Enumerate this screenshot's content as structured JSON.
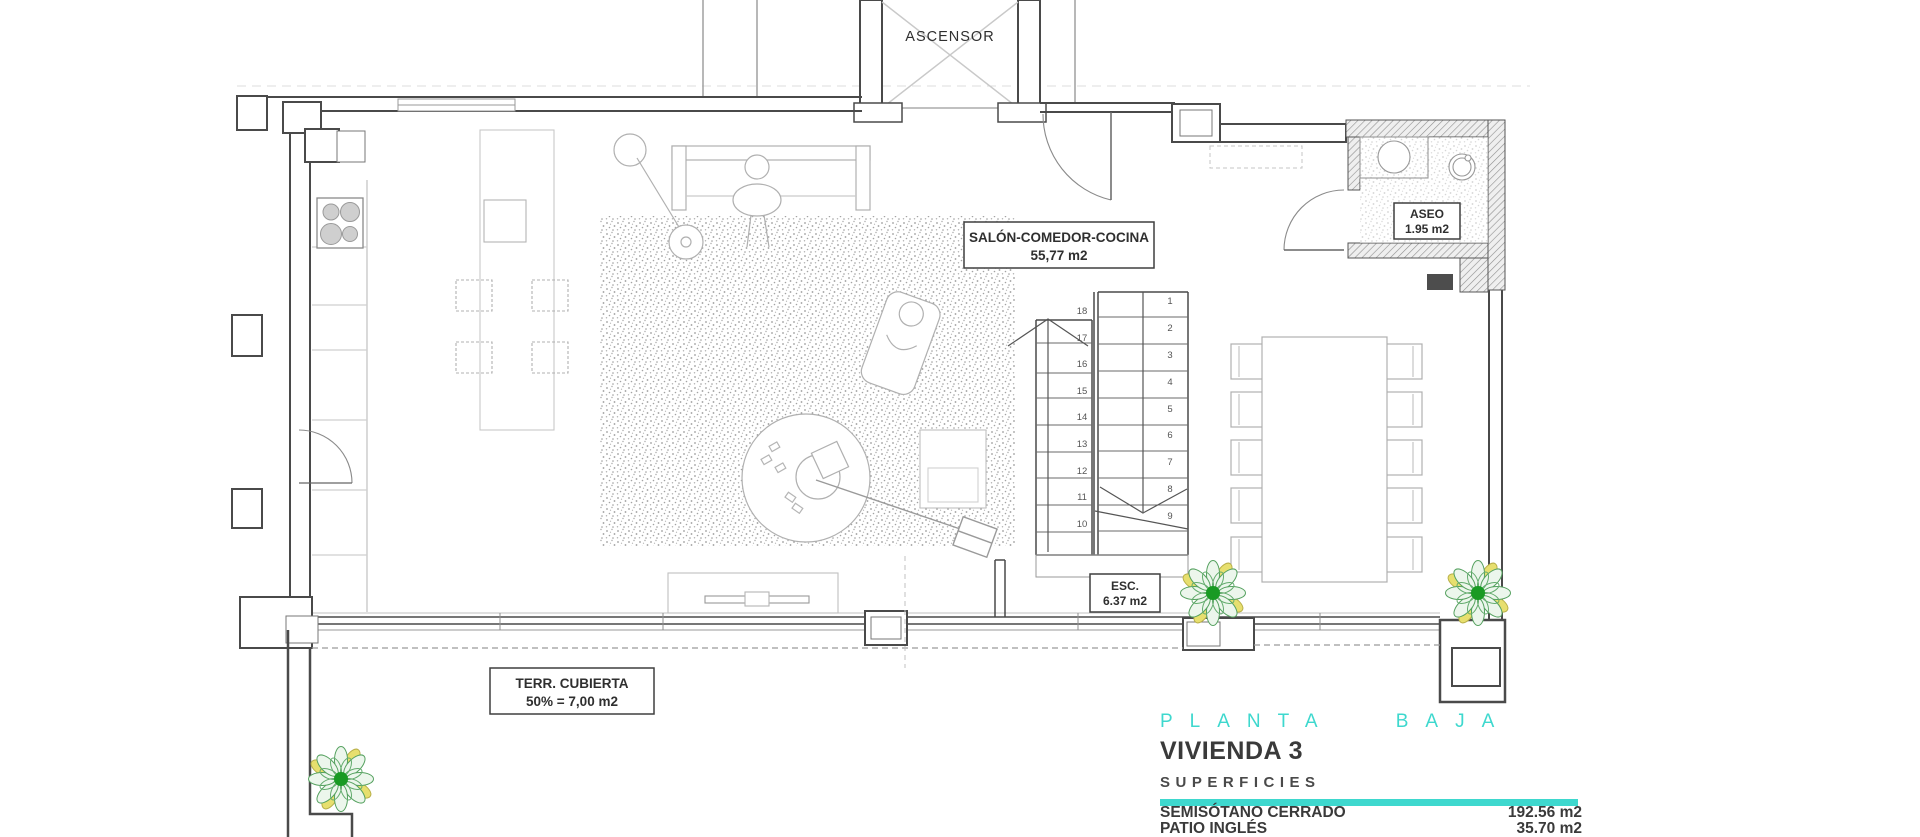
{
  "plan": {
    "elevator": {
      "label": "ASCENSOR"
    },
    "salon": {
      "line1": "SALÓN-COMEDOR-COCINA",
      "line2": "55,77 m2"
    },
    "aseo": {
      "line1": "ASEO",
      "line2": "1.95 m2"
    },
    "stairs_label": {
      "line1": "ESC.",
      "line2": "6.37 m2"
    },
    "terrace": {
      "line1": "TERR. CUBIERTA",
      "line2": "50% = 7,00 m2"
    },
    "stairs": {
      "flight_down_numbers": [
        "1",
        "2",
        "3",
        "4",
        "5",
        "6",
        "7",
        "8",
        "9"
      ],
      "flight_up_numbers": [
        "10",
        "11",
        "12",
        "13",
        "14",
        "15",
        "16",
        "17",
        "18"
      ]
    }
  },
  "title_block": {
    "floor_title": "PLANTA BAJA",
    "unit_title": "VIVIENDA 3",
    "section_title": "SUPERFICIES",
    "surfaces": [
      {
        "label": "SEMISÓTANO CERRADO",
        "value": "192.56 m2"
      },
      {
        "label": "PATIO INGLÉS",
        "value": "35.70 m2"
      },
      {
        "label": "VIVIENDA CERRADA P. BAJA",
        "value": "72.41 m2"
      }
    ]
  },
  "colors": {
    "accent_teal": "#3ed8ce",
    "wall_dark": "#4a4a4a",
    "furniture_gray": "#b0b0b0",
    "plant_green": "#199a23",
    "plant_yellow": "#e7df6e"
  },
  "icons": [
    "plant-icon",
    "stove-icon",
    "sink-icon",
    "basin-icon",
    "floor-lamp-icon",
    "person-figure"
  ]
}
